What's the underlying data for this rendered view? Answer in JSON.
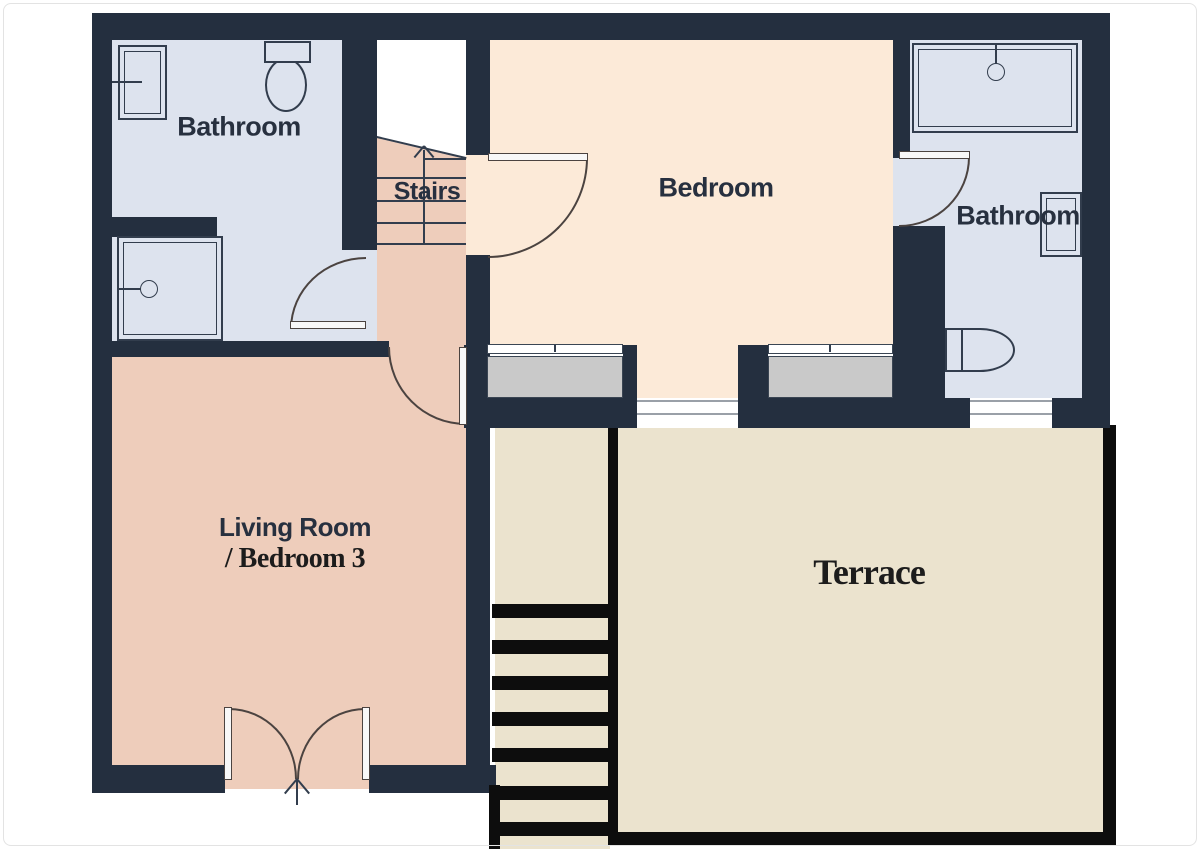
{
  "title": "Floor plan",
  "rooms": {
    "bathroom_left": {
      "label": "Bathroom"
    },
    "stairs": {
      "label": "Stairs"
    },
    "bedroom": {
      "label": "Bedroom"
    },
    "bathroom_right": {
      "label": "Bathroom"
    },
    "living_room": {
      "label_line1": "Living Room",
      "label_line2": "/ Bedroom 3"
    },
    "terrace": {
      "label": "Terrace"
    }
  },
  "colors": {
    "wall": "#242f3f",
    "bath-floor": "#dde3ee",
    "bedroom-floor": "#fcead8",
    "living-floor": "#eecdbb",
    "terrace-floor": "#ebe3ce",
    "sill": "#c9c9c9",
    "fixture-line": "#323d4d",
    "door-line": "#4b4340",
    "outline-black": "#0d0d0d",
    "label-sans": "#27303f",
    "label-serif": "#1c1c1c",
    "threshold-line": "#9aa0a8"
  }
}
